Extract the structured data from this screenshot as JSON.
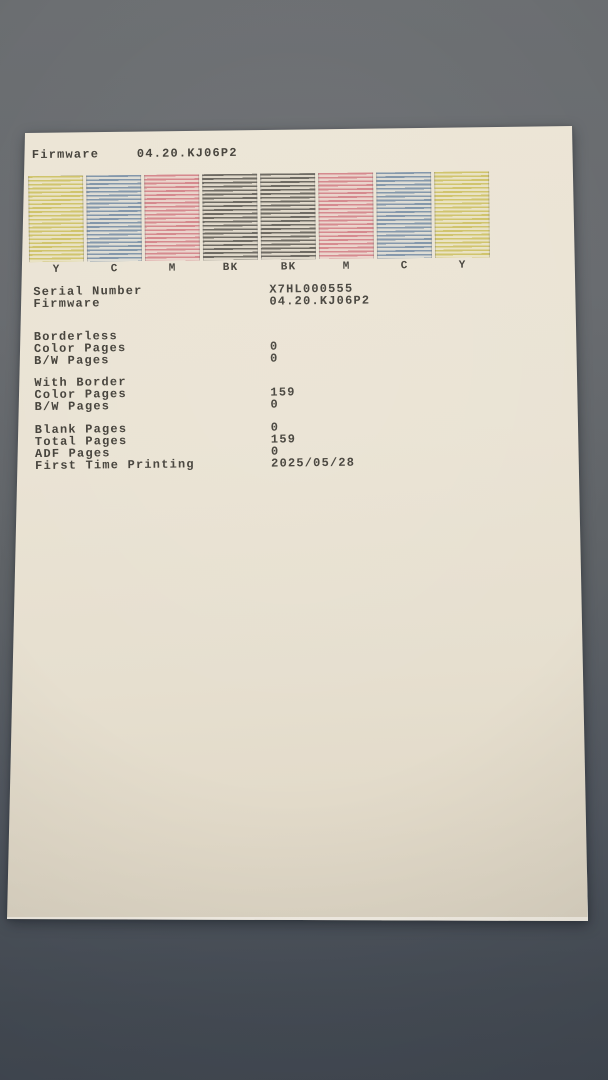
{
  "photo": {
    "background_top_color": "#6c6f72",
    "background_bottom_color": "#444b55",
    "paper_color": "#eae2d2",
    "ink_color": "#45423b"
  },
  "paper": {
    "header": {
      "label": "Firmware",
      "value": "04.20.KJ06P2"
    },
    "nozzle_bars": [
      {
        "label": "Y",
        "stripe": "#cfc36a",
        "tint": "#e9e2c3"
      },
      {
        "label": "C",
        "stripe": "#8195a9",
        "tint": "#dddcd4"
      },
      {
        "label": "M",
        "stripe": "#d4868b",
        "tint": "#ead3ca"
      },
      {
        "label": "BK",
        "stripe": "#6a665e",
        "tint": "#ded7c8"
      },
      {
        "label": "BK",
        "stripe": "#6a665e",
        "tint": "#ded7c8"
      },
      {
        "label": "M",
        "stripe": "#d4868b",
        "tint": "#ead3ca"
      },
      {
        "label": "C",
        "stripe": "#8195a9",
        "tint": "#dddcd4"
      },
      {
        "label": "Y",
        "stripe": "#cfc36a",
        "tint": "#e9e2c3"
      }
    ],
    "device_info": [
      {
        "label": "Serial Number",
        "value": "X7HL000555"
      },
      {
        "label": "Firmware",
        "value": "04.20.KJ06P2"
      }
    ],
    "counters": [
      {
        "title": "Borderless",
        "rows": [
          {
            "label": "Color Pages",
            "value": "0"
          },
          {
            "label": "B/W Pages",
            "value": "0"
          }
        ]
      },
      {
        "title": "With Border",
        "rows": [
          {
            "label": "Color Pages",
            "value": "159"
          },
          {
            "label": "B/W Pages",
            "value": "0"
          }
        ]
      },
      {
        "title": "",
        "rows": [
          {
            "label": "Blank Pages",
            "value": "0"
          },
          {
            "label": "Total Pages",
            "value": "159"
          },
          {
            "label": "ADF Pages",
            "value": "0"
          },
          {
            "label": "First Time Printing",
            "value": "2025/05/28"
          }
        ]
      }
    ]
  }
}
